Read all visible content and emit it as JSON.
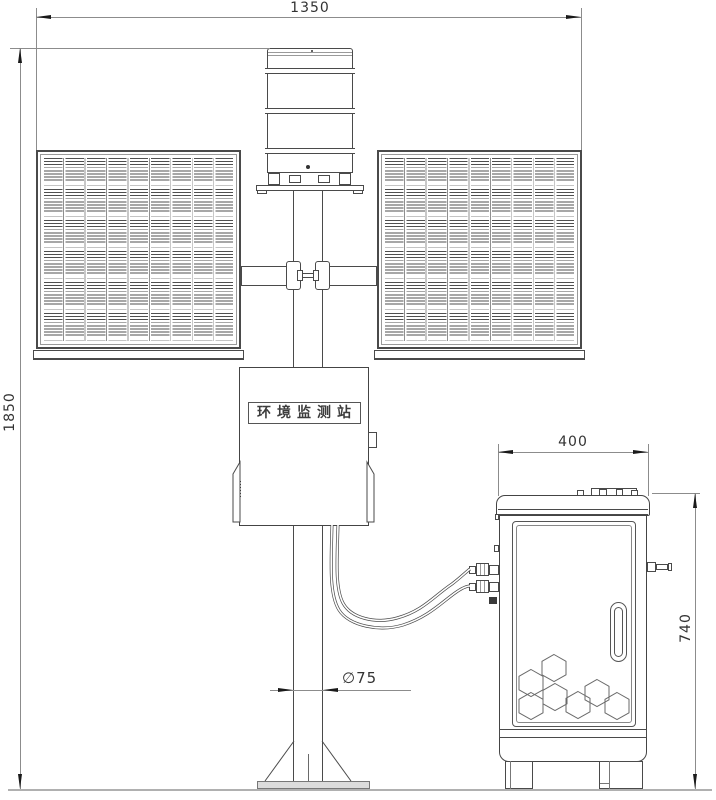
{
  "labels": {
    "station_box": "环境监测站"
  },
  "dimensions": {
    "overall_width": "1350",
    "overall_height": "1850",
    "cabinet_width": "400",
    "cabinet_height": "740",
    "pole_diameter": "∅75"
  },
  "components": {
    "left_solar_panel": "solar-panel",
    "right_solar_panel": "solar-panel",
    "top_sensor": "louvered-sensor-shield",
    "control_box": "station-control-box",
    "equipment_cabinet": "equipment-cabinet",
    "mount_pole": "mount-pole"
  },
  "colors": {
    "outline": "#4a4a4a",
    "dimension_line": "#8c8c8c",
    "arrow": "#1a1a1a",
    "background": "#ffffff",
    "base_plate_fill": "#dcdcdc"
  }
}
